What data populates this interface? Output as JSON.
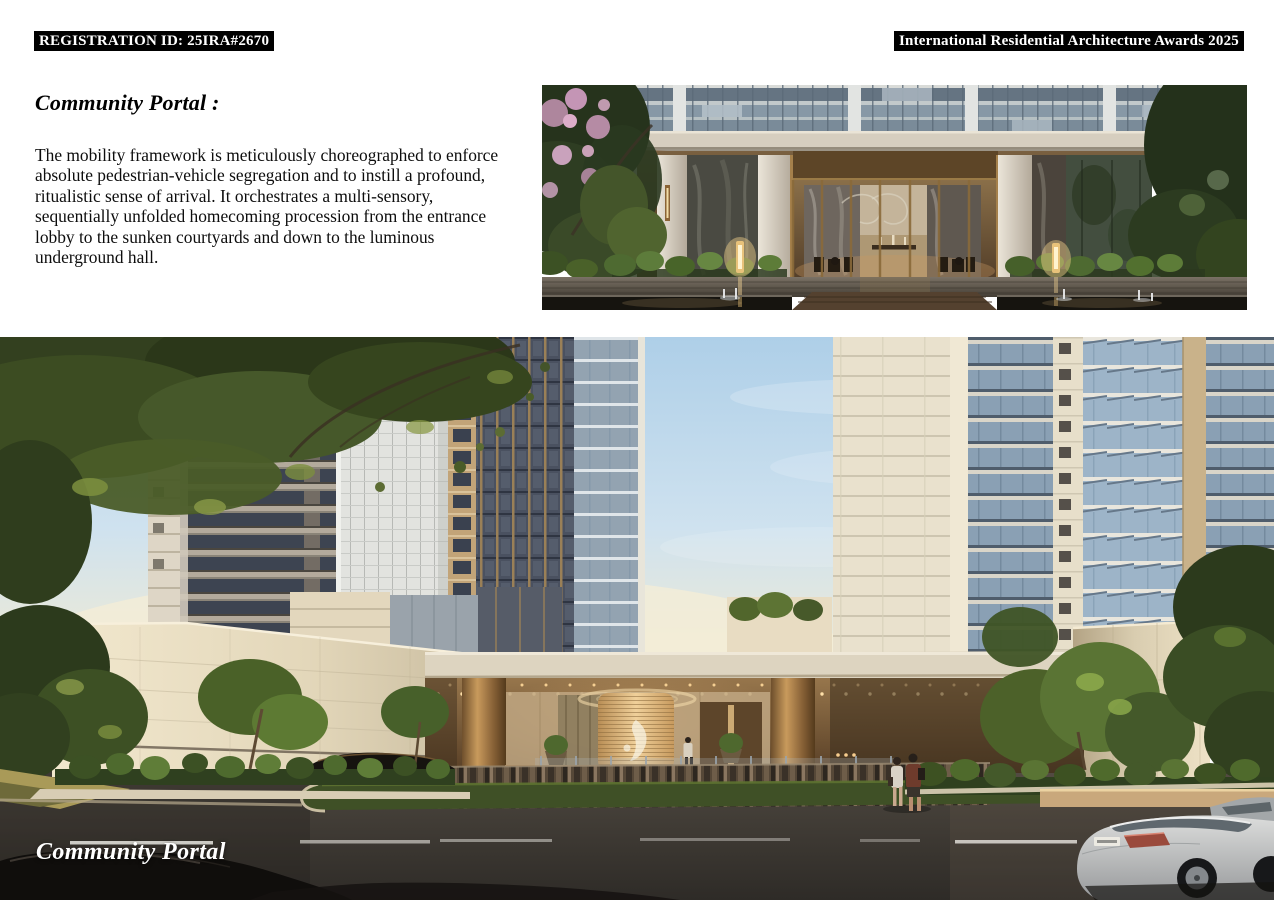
{
  "palette": {
    "page_bg": "#ffffff",
    "badge_bg": "#000000",
    "badge_text": "#ffffff",
    "heading_text": "#000000",
    "body_text": "#0d0d0d",
    "caption_text": "#ffffff",
    "render_bronze": "#b8894e",
    "render_stone": "#ddd3c0",
    "render_sky": "#cfe2ef"
  },
  "header": {
    "registration_id": "REGISTRATION ID: 25IRA#2670",
    "award_title": "International Residential Architecture Awards 2025"
  },
  "section": {
    "heading": "Community Portal :",
    "body_lines": [
      "The mobility framework is meticulously choreographed to enforce",
      "absolute pedestrian-vehicle segregation and to instill a profound,",
      "ritualistic sense of arrival. It orchestrates a multi-sensory,",
      "sequentially unfolded homecoming procession from the entrance",
      "lobby to the sunken courtyards and down to the luminous",
      "underground hall."
    ]
  },
  "images": {
    "lobby_render_alt": "Dusk rendering of the residential entrance lobby with bronze-framed glass walls, marble piers, flowering trees, glowing lanterns and a reflecting pool",
    "portal_render_alt": "Street-level rendering of the community portal drop-off canopy between residential towers with bronze columns, a glass drum pavilion and passing cars",
    "portal_caption": "Community Portal"
  }
}
